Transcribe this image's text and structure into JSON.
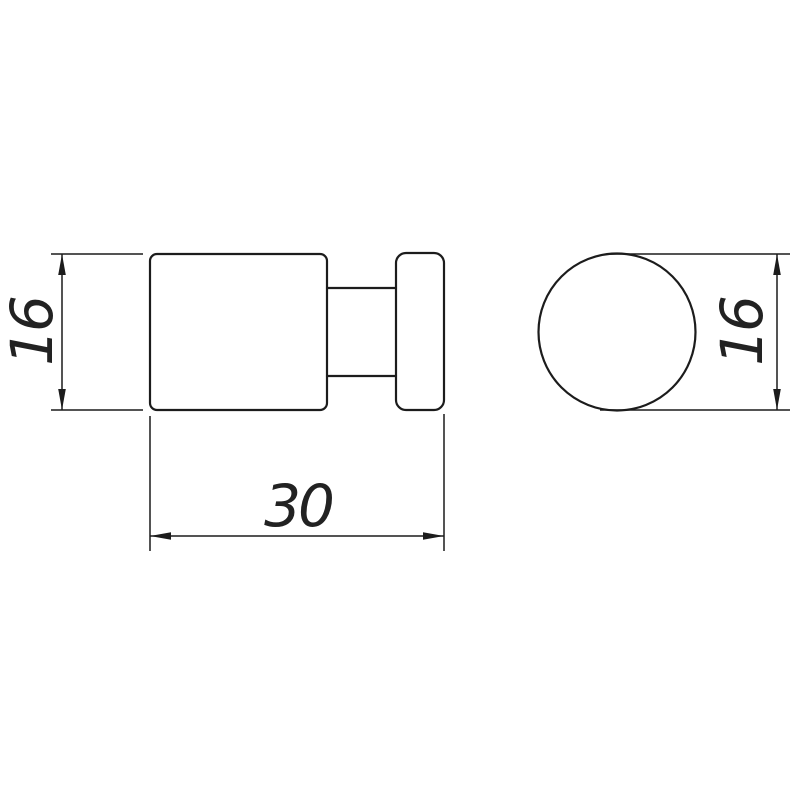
{
  "page": {
    "background_color": "#ffffff",
    "line_color": "#1c1c1c"
  },
  "drawing": {
    "type": "technical-dimension-drawing",
    "dimensions": {
      "side_height_label": "16",
      "side_length_label": "30",
      "front_diameter_label": "16"
    }
  }
}
